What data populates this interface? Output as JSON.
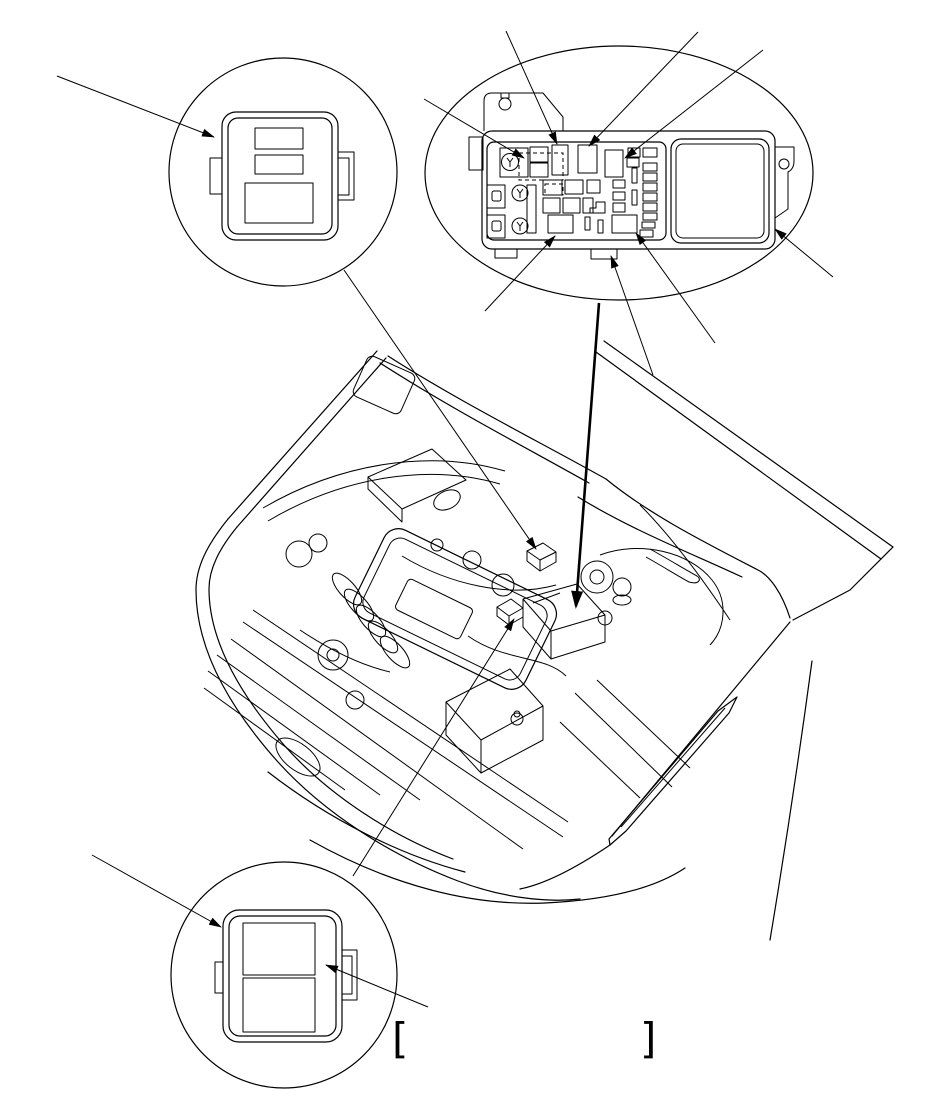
{
  "canvas": {
    "width": 950,
    "height": 1103,
    "background": "#ffffff",
    "ink": "#000000"
  },
  "figure": {
    "kind": "engine-compartment component location diagram",
    "brackets": {
      "left": "[",
      "right": "]"
    },
    "callouts": {
      "top_left": {
        "shape": "circle",
        "component": "relay (3-terminal, side tabs)"
      },
      "top_right": {
        "shape": "ellipse",
        "component": "under-hood fuse/relay box, top view"
      },
      "bottom_left": {
        "shape": "circle",
        "component": "relay (2-window, side tabs)"
      }
    },
    "fuse_box": {
      "screws": 3,
      "large_fuses_bottom": 2,
      "relays_top_row": 3,
      "small_fuse_slots_right_column": 8,
      "cover": "large removable cover on right side",
      "mount_tabs": 2
    },
    "engine_bay": {
      "items": [
        "valve-cover",
        "intake-runners",
        "battery",
        "strut-tower",
        "under-hood-fuse-box",
        "small-relay-a",
        "small-relay-b",
        "headlight",
        "grille",
        "fog-light",
        "open-hood"
      ]
    }
  }
}
